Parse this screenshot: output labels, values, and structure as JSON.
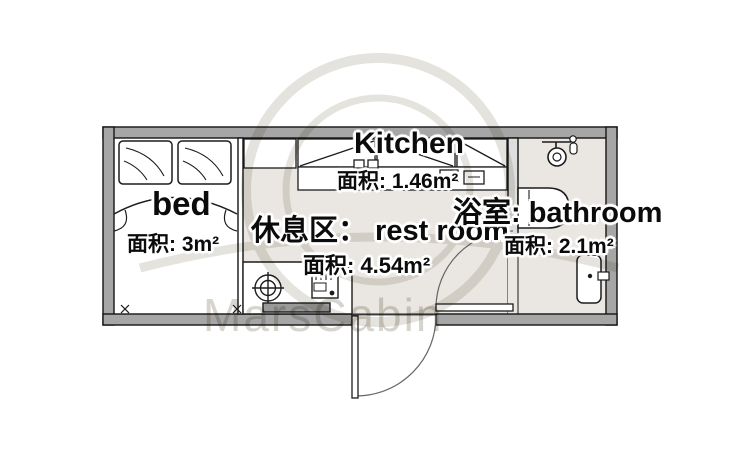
{
  "watermark": {
    "brand": "MarsCabin"
  },
  "rooms": {
    "bed": {
      "label": "bed",
      "area": "面积: 3m²"
    },
    "kitchen": {
      "label": "Kitchen",
      "area": "面积: 1.46m²"
    },
    "rest": {
      "label": "休息区： rest room",
      "area": "面积: 4.54m²"
    },
    "bathroom": {
      "label": "浴室: bathroom",
      "area": "面积: 2.1m²"
    }
  },
  "colors": {
    "wall": "#a6a6a6",
    "floor_common": "#eae7e2",
    "floor_bedroom": "#ffffff",
    "line": "#1c1c1c",
    "watermark": "#d7d4ce"
  }
}
